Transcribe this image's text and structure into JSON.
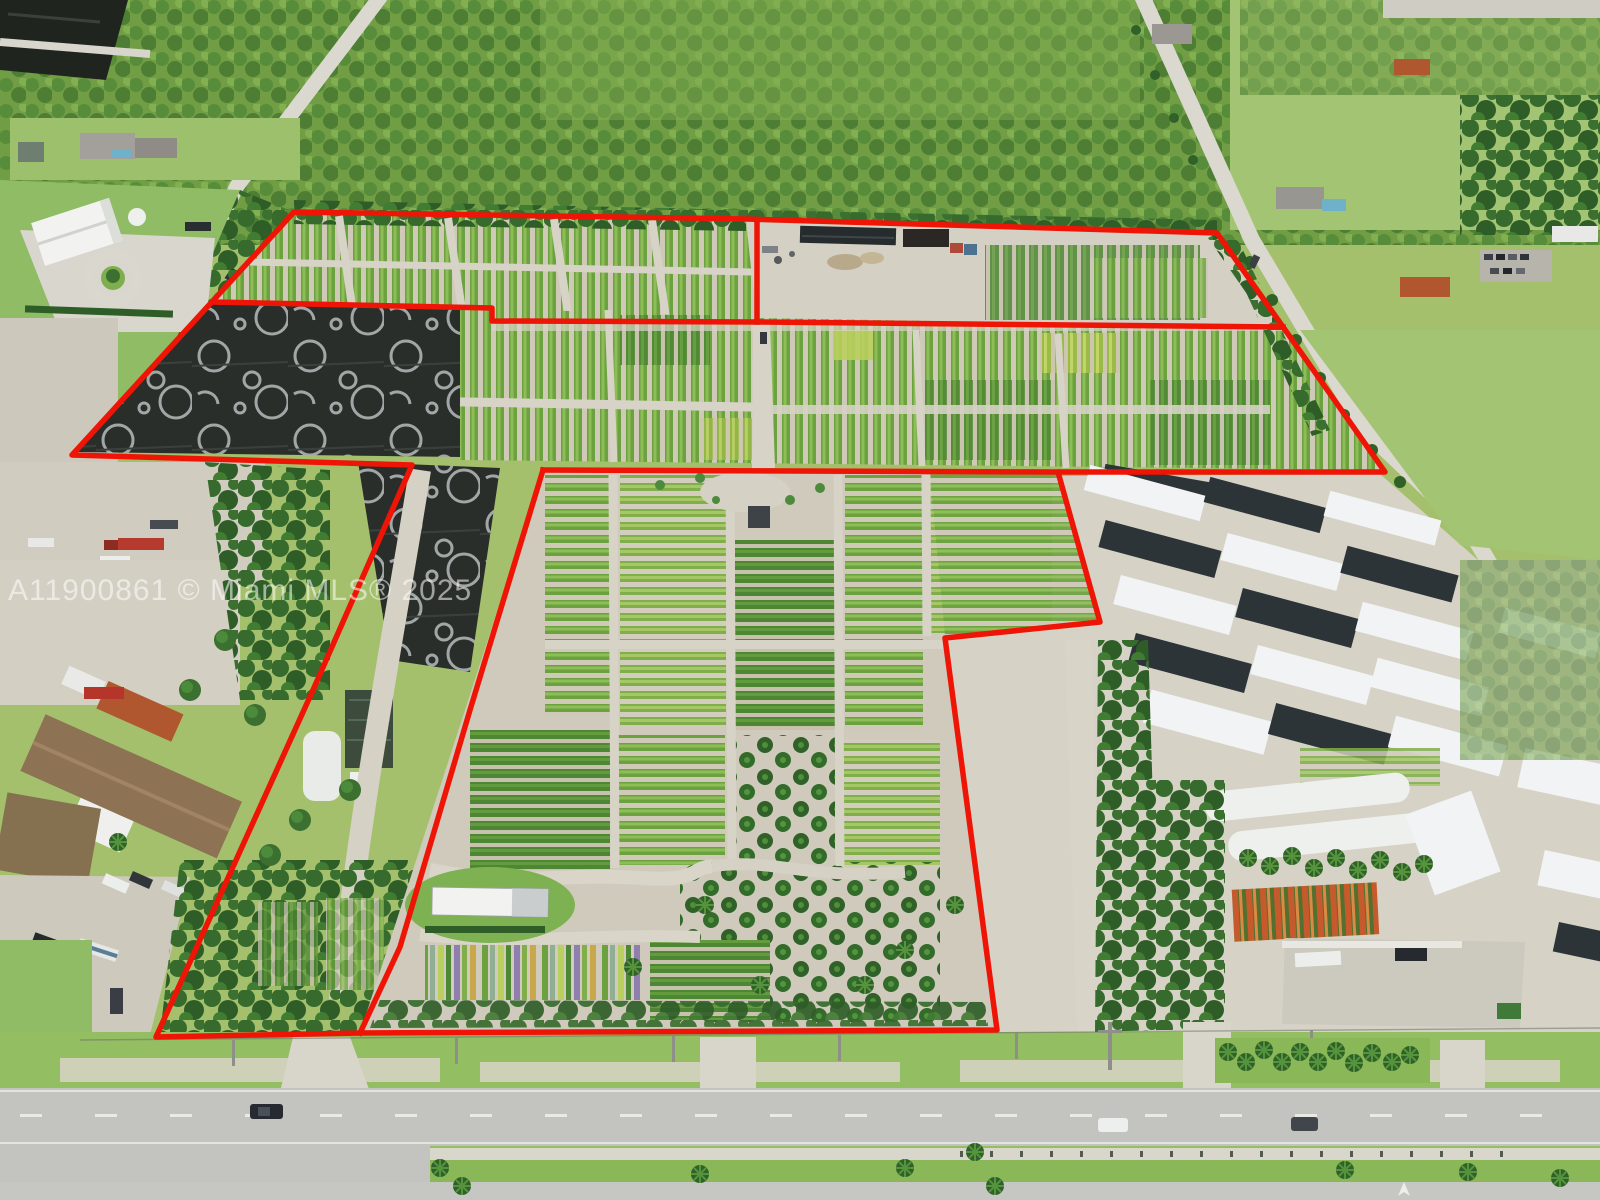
{
  "watermark": {
    "text": "A11900861 © Miami MLS® 2025"
  },
  "overlay": {
    "color": "#ee1506",
    "outer_boundary_points": "72,455 294,212 746,219 1217,233 1385,472 1058,472 1100,622 945,638 997,1030 360,1033 156,1037 313,690 412,465",
    "upper_division_points": "212,302 492,308 492,321 757,322 1283,327",
    "upper_vertical_division_points": "757,220 757,322",
    "middle_division_points": "543,470 1058,472",
    "diagonal_division_points": "543,470 470,710 400,947 360,1033"
  }
}
